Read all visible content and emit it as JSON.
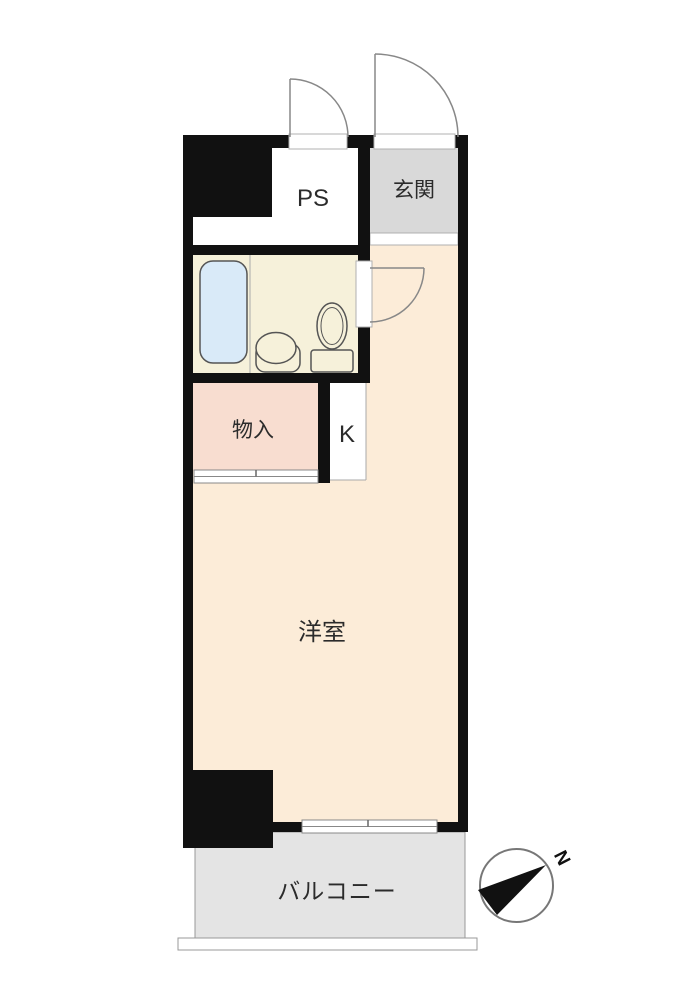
{
  "plan": {
    "type": "apartment-floor-plan",
    "rooms": {
      "ps": {
        "label": "PS"
      },
      "entrance": {
        "label": "玄関"
      },
      "bathroom": {
        "label": ""
      },
      "storage": {
        "label": "物入"
      },
      "kitchen": {
        "label": "K"
      },
      "western_room": {
        "label": "洋室"
      },
      "balcony": {
        "label": "バルコニー"
      }
    },
    "compass": {
      "north_label": "N"
    },
    "colors": {
      "wall": "#111111",
      "ps": "#ffffff",
      "entrance": "#d9d9d9",
      "entrance_step": "#ffffff",
      "bathroom": "#f6f1da",
      "bathtub": "#d9eaf8",
      "storage": "#f8ddd0",
      "kitchen": "#ffffff",
      "western_room": "#fcecd8",
      "balcony": "#e4e4e4",
      "needle": "#111111"
    }
  }
}
